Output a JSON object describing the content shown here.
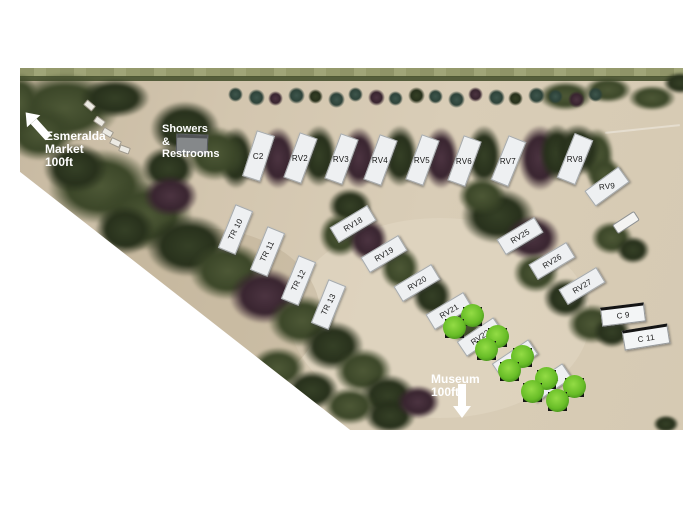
{
  "map": {
    "title": "RV park aerial site map",
    "colors": {
      "background": "#ffffff",
      "sand": "#d3c6af",
      "pad_fill": "#eef0f2",
      "pad_label_text": "#161616",
      "cabin_roof": "#141414",
      "bush_green": "#68bd27",
      "overlay_text": "#ffffff",
      "tree_dark": "#28311c"
    },
    "overlays": {
      "market": {
        "lines": [
          "Esmeralda",
          "Market",
          "100ft"
        ],
        "arrow_icon": "up-left-arrow"
      },
      "showers": {
        "lines": [
          "Showers",
          "&",
          "Restrooms"
        ]
      },
      "museum": {
        "lines": [
          "Museum",
          "100ft"
        ],
        "arrow_icon": "down-arrow"
      }
    },
    "sites": [
      {
        "label": "C2",
        "x": 237,
        "y": 87,
        "w": 17,
        "h": 46,
        "rot": 18,
        "trot": -18,
        "kind": "pad"
      },
      {
        "label": "RV2",
        "x": 279,
        "y": 89,
        "w": 17,
        "h": 46,
        "rot": 20,
        "trot": -20,
        "kind": "pad"
      },
      {
        "label": "RV3",
        "x": 320,
        "y": 90,
        "w": 17,
        "h": 46,
        "rot": 20,
        "trot": -20,
        "kind": "pad"
      },
      {
        "label": "RV4",
        "x": 359,
        "y": 91,
        "w": 17,
        "h": 46,
        "rot": 20,
        "trot": -20,
        "kind": "pad"
      },
      {
        "label": "RV5",
        "x": 401,
        "y": 91,
        "w": 17,
        "h": 46,
        "rot": 20,
        "trot": -20,
        "kind": "pad"
      },
      {
        "label": "RV6",
        "x": 443,
        "y": 92,
        "w": 17,
        "h": 46,
        "rot": 20,
        "trot": -20,
        "kind": "pad"
      },
      {
        "label": "RV7",
        "x": 487,
        "y": 92,
        "w": 17,
        "h": 46,
        "rot": 22,
        "trot": -22,
        "kind": "pad"
      },
      {
        "label": "RV8",
        "x": 554,
        "y": 90,
        "w": 18,
        "h": 46,
        "rot": 22,
        "trot": -22,
        "kind": "pad"
      },
      {
        "label": "RV9",
        "x": 586,
        "y": 117,
        "w": 40,
        "h": 17,
        "rot": -36,
        "trot": 30,
        "kind": "pad"
      },
      {
        "label": "TR 10",
        "x": 214,
        "y": 160,
        "w": 17,
        "h": 45,
        "rot": 22,
        "trot": -85,
        "kind": "pad"
      },
      {
        "label": "TR 11",
        "x": 246,
        "y": 182,
        "w": 17,
        "h": 45,
        "rot": 22,
        "trot": -85,
        "kind": "pad"
      },
      {
        "label": "TR 12",
        "x": 277,
        "y": 211,
        "w": 17,
        "h": 45,
        "rot": 22,
        "trot": -85,
        "kind": "pad"
      },
      {
        "label": "TR 13",
        "x": 307,
        "y": 235,
        "w": 17,
        "h": 45,
        "rot": 22,
        "trot": -85,
        "kind": "pad"
      },
      {
        "label": "RV18",
        "x": 332,
        "y": 155,
        "w": 42,
        "h": 16,
        "rot": -31,
        "trot": 0,
        "kind": "pad"
      },
      {
        "label": "RV19",
        "x": 363,
        "y": 185,
        "w": 42,
        "h": 16,
        "rot": -31,
        "trot": 0,
        "kind": "pad"
      },
      {
        "label": "RV20",
        "x": 396,
        "y": 214,
        "w": 42,
        "h": 16,
        "rot": -31,
        "trot": 0,
        "kind": "pad"
      },
      {
        "label": "RV21",
        "x": 428,
        "y": 242,
        "w": 42,
        "h": 16,
        "rot": -31,
        "trot": 0,
        "kind": "pad"
      },
      {
        "label": "RV22",
        "x": 459,
        "y": 268,
        "w": 42,
        "h": 16,
        "rot": -34,
        "trot": 0,
        "kind": "pad"
      },
      {
        "label": "RV23",
        "x": 494,
        "y": 290,
        "w": 42,
        "h": 16,
        "rot": -34,
        "trot": 0,
        "kind": "pad"
      },
      {
        "label": "RV24",
        "x": 528,
        "y": 314,
        "w": 42,
        "h": 16,
        "rot": -34,
        "trot": 0,
        "kind": "pad"
      },
      {
        "label": "RV25",
        "x": 499,
        "y": 167,
        "w": 42,
        "h": 16,
        "rot": -31,
        "trot": 0,
        "kind": "pad"
      },
      {
        "label": "RV26",
        "x": 531,
        "y": 192,
        "w": 42,
        "h": 16,
        "rot": -31,
        "trot": 0,
        "kind": "pad"
      },
      {
        "label": "RV27",
        "x": 561,
        "y": 217,
        "w": 42,
        "h": 16,
        "rot": -31,
        "trot": 0,
        "kind": "pad"
      },
      {
        "label": "C 9",
        "x": 602,
        "y": 244,
        "w": 42,
        "h": 15,
        "rot": -7,
        "trot": 0,
        "kind": "cabin"
      },
      {
        "label": "C 11",
        "x": 625,
        "y": 267,
        "w": 44,
        "h": 16,
        "rot": -9,
        "trot": 0,
        "kind": "cabin"
      }
    ],
    "bushes": [
      {
        "x": 453,
        "y": 249
      },
      {
        "x": 435,
        "y": 261
      },
      {
        "x": 478,
        "y": 270
      },
      {
        "x": 467,
        "y": 283
      },
      {
        "x": 503,
        "y": 290
      },
      {
        "x": 490,
        "y": 304
      },
      {
        "x": 527,
        "y": 312
      },
      {
        "x": 513,
        "y": 325
      },
      {
        "x": 555,
        "y": 320
      },
      {
        "x": 538,
        "y": 334
      }
    ]
  }
}
